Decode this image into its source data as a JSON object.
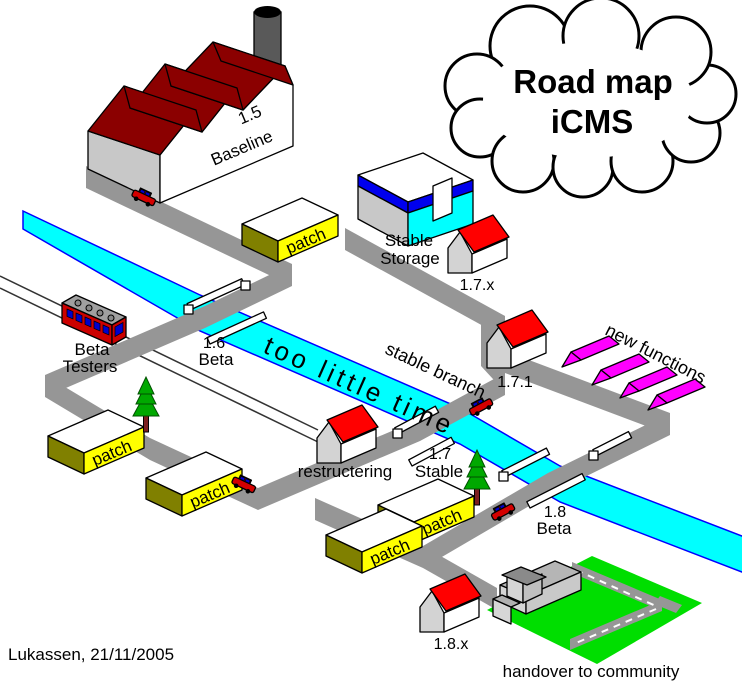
{
  "diagram": {
    "type": "isometric software release roadmap"
  },
  "labels": {
    "title1": "Road map",
    "title2": "iCMS",
    "baseline_version": "1.5",
    "baseline_name": "Baseline",
    "patch": "patch",
    "storage1": "Stable",
    "storage2": "Storage",
    "v17x": "1.7.x",
    "beta_testers1": "Beta",
    "beta_testers2": "Testers",
    "v16": "1.6",
    "v16_name": "Beta",
    "too_little_time": "too little time",
    "stable_branch": "stable branch",
    "v171": "1.7.1",
    "new_functions": "new functions",
    "restructering": "restructering",
    "v17": "1.7",
    "v17_name": "Stable",
    "v18": "1.8",
    "v18_name": "Beta",
    "v18x": "1.8.x",
    "handover": "handover to community",
    "author": "Lukassen, 21/11/2005"
  },
  "colors": {
    "road": "#969696",
    "river": "#00FFFF",
    "river_edge": "#0000FF",
    "field": "#00DE00",
    "patch_yellow": "#FFFF00",
    "patch_olive": "#808000",
    "factory_roof": "#8B0000",
    "house_roof": "#FF0000",
    "tent": "#FF00FF",
    "storage_blue": "#0000EE",
    "storage_cyan": "#00FFFF",
    "car_red": "#D40000",
    "train_red": "#CC0000",
    "window_blue": "#0000CC",
    "tree_green": "#00A800"
  }
}
